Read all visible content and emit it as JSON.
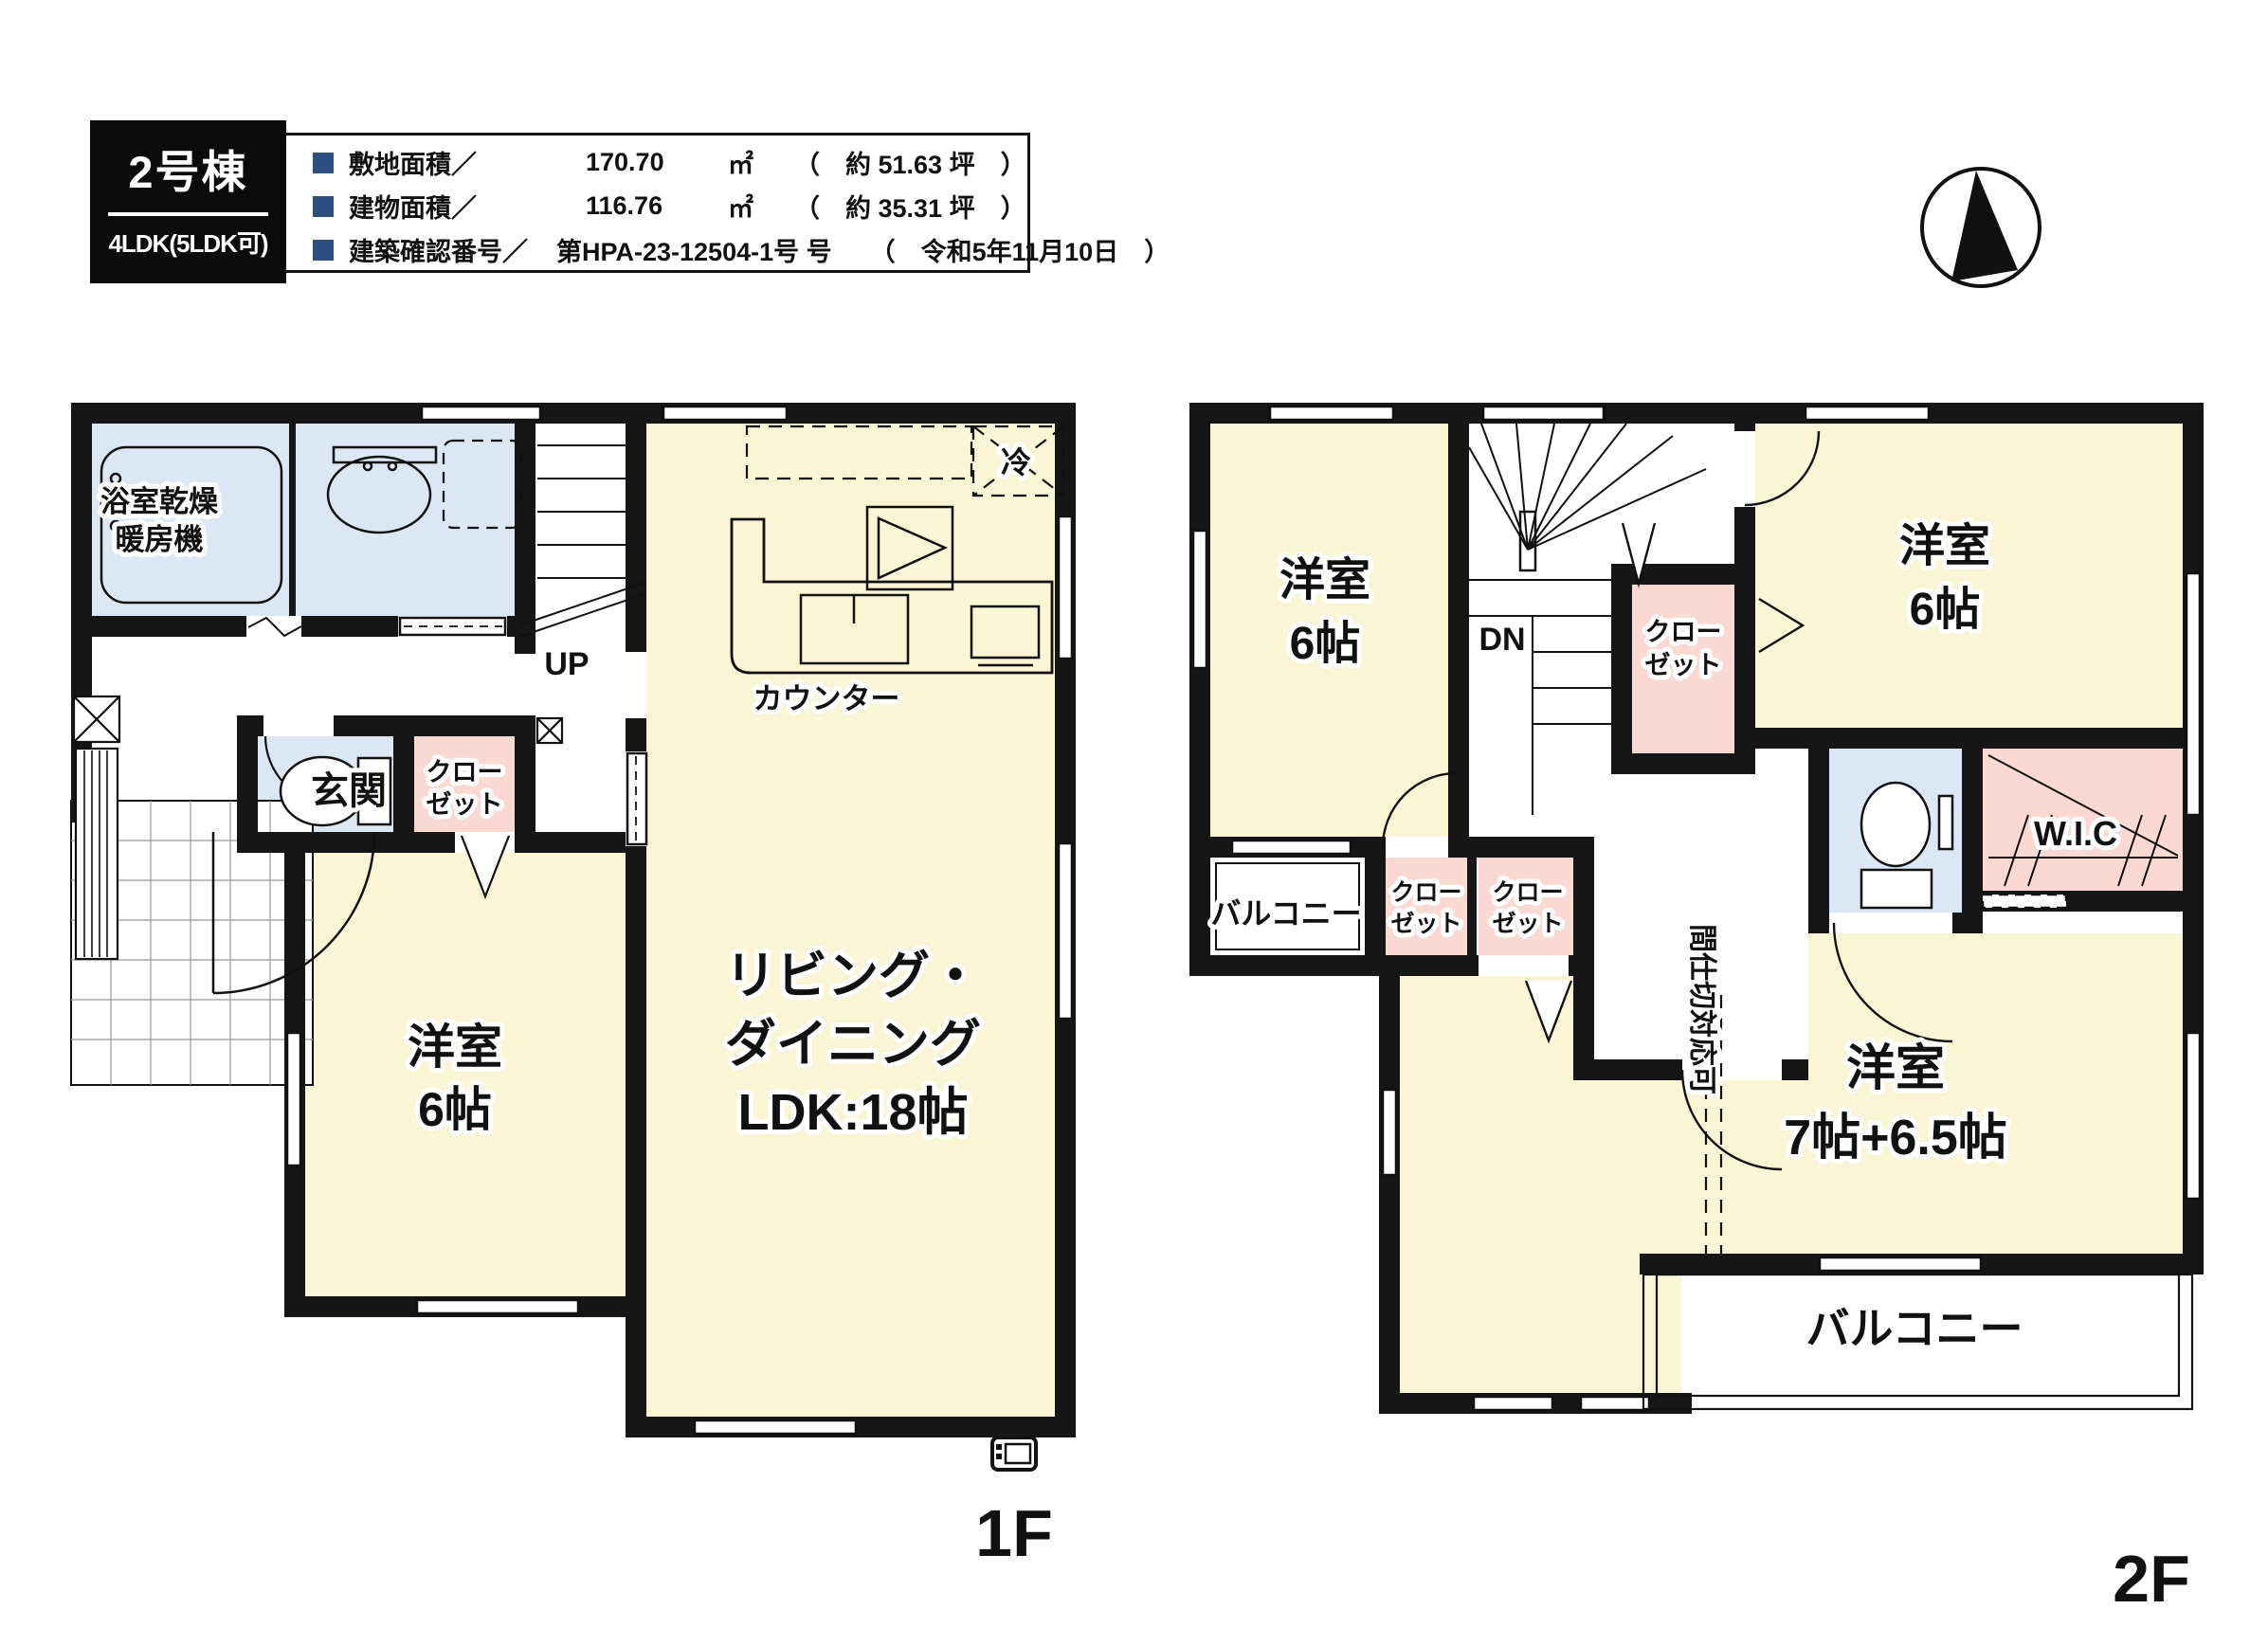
{
  "header": {
    "unit": "2号棟",
    "plan": "4LDK(5LDK可)",
    "rows": [
      {
        "label": "敷地面積／",
        "value": "170.70",
        "unit": "㎡",
        "note": "（　約 51.63 坪　）"
      },
      {
        "label": "建物面積／",
        "value": "116.76",
        "unit": "㎡",
        "note": "（　約 35.31 坪　）"
      },
      {
        "label": "建築確認番号／",
        "value": "第HPA-23-12504-1号 号",
        "unit": "",
        "note": "（　令和5年11月10日　）"
      }
    ]
  },
  "floor1": {
    "label": "1F",
    "bath_l1": "浴室乾燥",
    "bath_l2": "暖房機",
    "entrance": "玄関",
    "closet_l1": "クロー",
    "closet_l2": "ゼット",
    "bedroom_l1": "洋室",
    "bedroom_l2": "6帖",
    "ldk_l1": "リビング・",
    "ldk_l2": "ダイニング",
    "ldk_l3": "LDK:18帖",
    "up": "UP",
    "counter": "カウンター",
    "fridge": "冷"
  },
  "floor2": {
    "label": "2F",
    "bedroom_nw_l1": "洋室",
    "bedroom_nw_l2": "6帖",
    "bedroom_ne_l1": "洋室",
    "bedroom_ne_l2": "6帖",
    "bedroom_s_l1": "洋室",
    "bedroom_s_l2": "7帖+6.5帖",
    "closet_l1": "クロー",
    "closet_l2": "ゼット",
    "wic": "W.I.C",
    "balcony": "バルコニー",
    "dn": "DN",
    "partition": "間仕切対応可"
  },
  "colors": {
    "wall": "#161616",
    "room_yellow": "#FAF6D5",
    "wet_blue": "#DBE8F3",
    "closet_pink": "#F9D9D1",
    "accent_navy": "#2B4F81",
    "tile_line": "#999999"
  }
}
